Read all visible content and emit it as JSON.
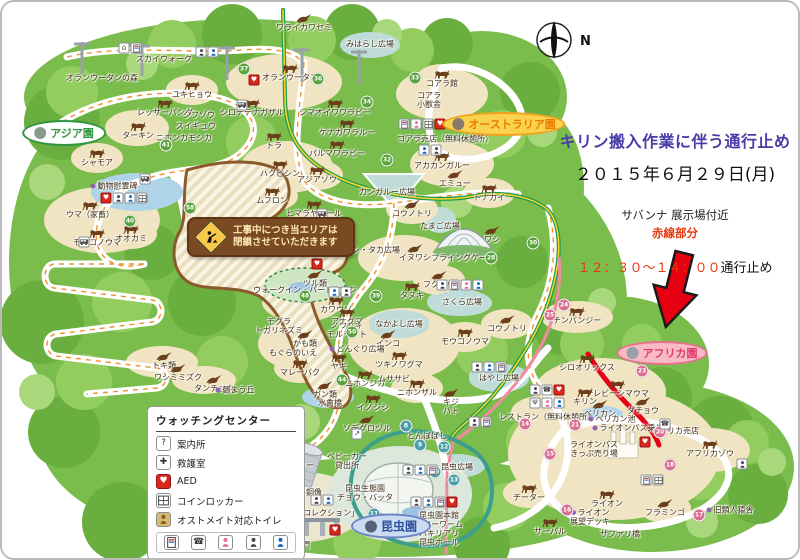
{
  "notice": {
    "title": "キリン搬入作業に伴う通行止め",
    "date": "２０１５年６月２９日(月)",
    "location_line1": "サバンナ 展示場付近",
    "location_line2": "赤線部分",
    "time": "１２：３０～１４：００",
    "time_suffix": "通行止め",
    "title_color": "#4a3ca8",
    "highlight_color": "#e8380d"
  },
  "compass": {
    "label": "N"
  },
  "construction_sign": {
    "line1": "工事中につき当エリアは",
    "line2": "閉鎖させていただきます"
  },
  "legend": {
    "title": "ウォッチングセンター",
    "items": [
      {
        "icon": "info",
        "label": "案内所"
      },
      {
        "icon": "firstaid",
        "label": "救護室"
      },
      {
        "icon": "aed",
        "label": "AED"
      },
      {
        "icon": "locker",
        "label": "コインロッカー"
      },
      {
        "icon": "ostomate",
        "label": "オストメイト対応トイレ"
      }
    ],
    "footer_icons": [
      "vending",
      "phone",
      "baby",
      "toilet",
      "wheelchair"
    ]
  },
  "areas": [
    {
      "id": "asia",
      "label": "アジア園",
      "x": 62,
      "y": 131
    },
    {
      "id": "australia",
      "label": "オーストラリア園",
      "x": 502,
      "y": 122
    },
    {
      "id": "africa",
      "label": "アフリカ園",
      "x": 660,
      "y": 351
    },
    {
      "id": "insect",
      "label": "昆虫園",
      "x": 389,
      "y": 524
    }
  ],
  "map": {
    "labels": [
      {
        "t": "ワライカワセミ",
        "x": 302,
        "y": 20,
        "k": "b",
        "np": 1
      },
      {
        "t": "みはらし広場",
        "x": 368,
        "y": 42,
        "k": "p"
      },
      {
        "t": "スカイウォーク",
        "x": 162,
        "y": 57,
        "k": "f"
      },
      {
        "t": "オランウータンの森",
        "x": 100,
        "y": 76,
        "k": "f"
      },
      {
        "t": "オランウータン",
        "x": 288,
        "y": 70,
        "k": "a"
      },
      {
        "t": "シロテテナガザル",
        "x": 250,
        "y": 105,
        "k": "a",
        "np": 1
      },
      {
        "t": "シマオイワワラビー",
        "x": 333,
        "y": 105,
        "k": "a",
        "np": 1
      },
      {
        "t": "ケナガワラルー",
        "x": 345,
        "y": 125,
        "k": "a",
        "np": 1
      },
      {
        "t": "パルマワラビー",
        "x": 335,
        "y": 146,
        "k": "a",
        "np": 1
      },
      {
        "t": "ユキヒョウ",
        "x": 190,
        "y": 87,
        "k": "a"
      },
      {
        "t": "レッサーパンダ",
        "x": 163,
        "y": 105,
        "k": "a",
        "np": 1
      },
      {
        "t": "ターキン",
        "x": 136,
        "y": 128,
        "k": "a"
      },
      {
        "t": "シフゾウ",
        "x": 197,
        "y": 113,
        "k": "t"
      },
      {
        "t": "スイギュウ",
        "x": 194,
        "y": 124,
        "k": "t"
      },
      {
        "t": "ニホンカモシカ",
        "x": 182,
        "y": 136,
        "k": "t"
      },
      {
        "t": "シャモア",
        "x": 95,
        "y": 155,
        "k": "a"
      },
      {
        "t": "トラ",
        "x": 272,
        "y": 138,
        "k": "a",
        "np": 1
      },
      {
        "t": "ハクビシン",
        "x": 278,
        "y": 166,
        "k": "a",
        "np": 1
      },
      {
        "t": "アジアゾウ",
        "x": 315,
        "y": 172,
        "k": "a"
      },
      {
        "t": "ムフロン",
        "x": 270,
        "y": 193,
        "k": "a"
      },
      {
        "t": "ヒマラヤタール",
        "x": 312,
        "y": 206,
        "k": "a",
        "np": 1
      },
      {
        "t": "ウマ（家畜）",
        "x": 88,
        "y": 207,
        "k": "a",
        "np": 1
      },
      {
        "t": "モウコノウマ",
        "x": 95,
        "y": 235,
        "k": "a"
      },
      {
        "t": "オオカミ",
        "x": 129,
        "y": 231,
        "k": "a"
      },
      {
        "t": "動物慰霊碑",
        "x": 112,
        "y": 184,
        "k": "t",
        "d": 1
      },
      {
        "t": "コアラ館",
        "x": 440,
        "y": 76,
        "k": "a"
      },
      {
        "t": "コアラ\n小獣舎",
        "x": 427,
        "y": 98,
        "k": "t"
      },
      {
        "t": "コアラ売店（無料休憩所）",
        "x": 443,
        "y": 137,
        "k": "f"
      },
      {
        "t": "アカカンガルー",
        "x": 440,
        "y": 158,
        "k": "a",
        "np": 1
      },
      {
        "t": "エミュー",
        "x": 453,
        "y": 176,
        "k": "b",
        "np": 1
      },
      {
        "t": "トナカイ",
        "x": 487,
        "y": 190,
        "k": "a"
      },
      {
        "t": "カンガルー広場",
        "x": 385,
        "y": 190,
        "k": "t"
      },
      {
        "t": "インドサイ",
        "x": 313,
        "y": 222,
        "k": "a"
      },
      {
        "t": "コウノトリ",
        "x": 410,
        "y": 206,
        "k": "b"
      },
      {
        "t": "たまご広場",
        "x": 438,
        "y": 224,
        "k": "t"
      },
      {
        "t": "ワシ",
        "x": 490,
        "y": 232,
        "k": "b",
        "np": 1
      },
      {
        "t": "フライングケージ",
        "x": 461,
        "y": 256,
        "k": "f"
      },
      {
        "t": "イヌワシ",
        "x": 413,
        "y": 250,
        "k": "b",
        "np": 1
      },
      {
        "t": "ワシ・タカ広場",
        "x": 370,
        "y": 248,
        "k": "t"
      },
      {
        "t": "フクロウ",
        "x": 437,
        "y": 277,
        "k": "b"
      },
      {
        "t": "タヌキ",
        "x": 410,
        "y": 288,
        "k": "a",
        "np": 1
      },
      {
        "t": "さくら広場",
        "x": 460,
        "y": 300,
        "k": "p"
      },
      {
        "t": "コウノトリ",
        "x": 505,
        "y": 321,
        "k": "b"
      },
      {
        "t": "なかよし広場",
        "x": 397,
        "y": 322,
        "k": "p"
      },
      {
        "t": "インコ",
        "x": 386,
        "y": 336,
        "k": "b",
        "np": 1
      },
      {
        "t": "ツキノワグマ",
        "x": 397,
        "y": 357,
        "k": "a"
      },
      {
        "t": "モウコノウマ",
        "x": 463,
        "y": 334,
        "k": "a"
      },
      {
        "t": "ニホンジカ",
        "x": 363,
        "y": 376,
        "k": "a",
        "np": 1
      },
      {
        "t": "ムササビ",
        "x": 392,
        "y": 377,
        "k": "t"
      },
      {
        "t": "ニホンザル",
        "x": 415,
        "y": 385,
        "k": "a"
      },
      {
        "t": "イノシシ",
        "x": 371,
        "y": 400,
        "k": "a",
        "np": 1
      },
      {
        "t": "キジ\nハト",
        "x": 449,
        "y": 399,
        "k": "b",
        "np": 1
      },
      {
        "t": "ソデグロヅル",
        "x": 365,
        "y": 421,
        "k": "b",
        "np": 1
      },
      {
        "t": "ノウサギ\nモルモット",
        "x": 345,
        "y": 328,
        "k": "t"
      },
      {
        "t": "どんぐり広場",
        "x": 355,
        "y": 347,
        "k": "t",
        "d": 1
      },
      {
        "t": "ヤギ",
        "x": 337,
        "y": 359,
        "k": "a",
        "np": 1
      },
      {
        "t": "ツル類",
        "x": 313,
        "y": 276,
        "k": "b"
      },
      {
        "t": "ウォークイン・バードケージ",
        "x": 303,
        "y": 288,
        "k": "f"
      },
      {
        "t": "カワウソ",
        "x": 334,
        "y": 302,
        "k": "a",
        "np": 1
      },
      {
        "t": "アナグマ",
        "x": 345,
        "y": 314,
        "k": "a",
        "np": 1
      },
      {
        "t": "モグラ\nトガリネズミ",
        "x": 277,
        "y": 324,
        "k": "t"
      },
      {
        "t": "かも類",
        "x": 303,
        "y": 336,
        "k": "b",
        "np": 1
      },
      {
        "t": "もぐらのいえ",
        "x": 291,
        "y": 351,
        "k": "t"
      },
      {
        "t": "マレーバク",
        "x": 298,
        "y": 365,
        "k": "a"
      },
      {
        "t": "ガン類",
        "x": 323,
        "y": 387,
        "k": "b",
        "np": 1
      },
      {
        "t": "水禽橋",
        "x": 328,
        "y": 401,
        "k": "f"
      },
      {
        "t": "トキ類",
        "x": 162,
        "y": 358,
        "k": "b"
      },
      {
        "t": "ワシミミズク",
        "x": 176,
        "y": 370,
        "k": "b",
        "np": 1
      },
      {
        "t": "タンチョウ",
        "x": 212,
        "y": 381,
        "k": "b",
        "np": 1
      },
      {
        "t": "鶴まう丘",
        "x": 233,
        "y": 388,
        "k": "t",
        "d": 1
      },
      {
        "t": "とんぼばし",
        "x": 425,
        "y": 434,
        "k": "f"
      },
      {
        "t": "昆虫生態園\nチョウ・バッタ",
        "x": 363,
        "y": 491,
        "k": "t"
      },
      {
        "t": "昆虫園本館\nグローワーム\nハキリアリ\n昆虫ホール",
        "x": 437,
        "y": 527,
        "k": "t"
      },
      {
        "t": "昆虫広場",
        "x": 455,
        "y": 465,
        "k": "t"
      },
      {
        "t": "ベビーカー\n貸出所",
        "x": 345,
        "y": 459,
        "k": "t"
      },
      {
        "t": "ウォッチングセンター\n動物ホール\nズーカフェ\nカンカン・ランランの銅像",
        "x": 272,
        "y": 477,
        "k": "t"
      },
      {
        "t": "ギフトショップ「コレクション」",
        "x": 297,
        "y": 511,
        "k": "f"
      },
      {
        "t": "正門",
        "x": 300,
        "y": 543,
        "k": "t"
      },
      {
        "t": "はやし広場",
        "x": 497,
        "y": 376,
        "k": "p"
      },
      {
        "t": "レストラン（無料休憩所）",
        "x": 545,
        "y": 415,
        "k": "f"
      },
      {
        "t": "チンパンジー",
        "x": 575,
        "y": 313,
        "k": "a"
      },
      {
        "t": "シロオリックス",
        "x": 585,
        "y": 360,
        "k": "a",
        "np": 1
      },
      {
        "t": "グレビーシマウマ",
        "x": 615,
        "y": 386,
        "k": "a",
        "np": 1
      },
      {
        "t": "キリン",
        "x": 583,
        "y": 394,
        "k": "a",
        "np": 1
      },
      {
        "t": "ペリカン",
        "x": 598,
        "y": 406,
        "k": "b",
        "np": 1
      },
      {
        "t": "ダチョウ",
        "x": 641,
        "y": 403,
        "k": "b",
        "np": 1
      },
      {
        "t": "ペリカン池",
        "x": 610,
        "y": 417,
        "k": "t",
        "d": 1
      },
      {
        "t": "ライオンバス乗り場",
        "x": 630,
        "y": 426,
        "k": "t",
        "d": 1
      },
      {
        "t": "アフリカ売店",
        "x": 673,
        "y": 429,
        "k": "f"
      },
      {
        "t": "ライオンバス\nきっぷ売り場",
        "x": 592,
        "y": 447,
        "k": "t"
      },
      {
        "t": "ライオン",
        "x": 605,
        "y": 496,
        "k": "a"
      },
      {
        "t": "チーター",
        "x": 527,
        "y": 490,
        "k": "a"
      },
      {
        "t": "サーバル",
        "x": 548,
        "y": 524,
        "k": "a",
        "np": 1
      },
      {
        "t": "フラミンゴ",
        "x": 663,
        "y": 505,
        "k": "b"
      },
      {
        "t": "アフリカゾウ",
        "x": 708,
        "y": 446,
        "k": "a"
      },
      {
        "t": "ライオン\n展望デッキ",
        "x": 588,
        "y": 515,
        "k": "t",
        "d": 1
      },
      {
        "t": "サファリ橋",
        "x": 618,
        "y": 532,
        "k": "f"
      },
      {
        "t": "旧類人猿舎",
        "x": 728,
        "y": 508,
        "k": "t",
        "d": 1
      }
    ],
    "route_markers": [
      {
        "n": "37",
        "x": 242,
        "y": 67,
        "c": "g"
      },
      {
        "n": "36",
        "x": 316,
        "y": 77,
        "c": "g"
      },
      {
        "n": "33",
        "x": 413,
        "y": 76,
        "c": "g"
      },
      {
        "n": "34",
        "x": 365,
        "y": 100,
        "c": "g"
      },
      {
        "n": "32",
        "x": 385,
        "y": 158,
        "c": "g"
      },
      {
        "n": "41",
        "x": 164,
        "y": 143,
        "c": "g"
      },
      {
        "n": "58",
        "x": 188,
        "y": 206,
        "c": "g"
      },
      {
        "n": "40",
        "x": 128,
        "y": 219,
        "c": "g"
      },
      {
        "n": "30",
        "x": 531,
        "y": 241,
        "c": "g"
      },
      {
        "n": "28",
        "x": 489,
        "y": 256,
        "c": "g"
      },
      {
        "n": "48",
        "x": 303,
        "y": 294,
        "c": "g"
      },
      {
        "n": "39",
        "x": 374,
        "y": 294,
        "c": "g"
      },
      {
        "n": "50",
        "x": 350,
        "y": 330,
        "c": "g"
      },
      {
        "n": "44",
        "x": 340,
        "y": 378,
        "c": "g"
      },
      {
        "n": "8",
        "x": 404,
        "y": 424,
        "c": "t"
      },
      {
        "n": "9",
        "x": 418,
        "y": 443,
        "c": "t"
      },
      {
        "n": "12",
        "x": 442,
        "y": 445,
        "c": "t"
      },
      {
        "n": "10",
        "x": 433,
        "y": 470,
        "c": "t"
      },
      {
        "n": "11",
        "x": 372,
        "y": 512,
        "c": "t"
      },
      {
        "n": "13",
        "x": 452,
        "y": 478,
        "c": "t"
      },
      {
        "n": "14",
        "x": 523,
        "y": 422,
        "c": "p"
      },
      {
        "n": "21",
        "x": 573,
        "y": 423,
        "c": "p"
      },
      {
        "n": "15",
        "x": 548,
        "y": 452,
        "c": "p"
      },
      {
        "n": "20",
        "x": 658,
        "y": 430,
        "c": "p"
      },
      {
        "n": "18",
        "x": 668,
        "y": 463,
        "c": "p"
      },
      {
        "n": "16",
        "x": 565,
        "y": 508,
        "c": "p"
      },
      {
        "n": "17",
        "x": 697,
        "y": 513,
        "c": "p"
      },
      {
        "n": "23",
        "x": 640,
        "y": 369,
        "c": "p"
      },
      {
        "n": "24",
        "x": 562,
        "y": 303,
        "c": "p"
      },
      {
        "n": "25",
        "x": 548,
        "y": 313,
        "c": "p"
      }
    ],
    "icon_clusters": [
      {
        "x": 128,
        "y": 46,
        "i": [
          "shelter",
          "vending"
        ]
      },
      {
        "x": 205,
        "y": 50,
        "i": [
          "toilet",
          "wheelchair"
        ]
      },
      {
        "x": 252,
        "y": 78,
        "i": [
          "aed"
        ]
      },
      {
        "x": 240,
        "y": 103,
        "i": [
          "bus"
        ]
      },
      {
        "x": 143,
        "y": 177,
        "i": [
          "bus"
        ]
      },
      {
        "x": 82,
        "y": 240,
        "i": [
          "bus"
        ]
      },
      {
        "x": 320,
        "y": 212,
        "i": [
          "bus"
        ]
      },
      {
        "x": 122,
        "y": 196,
        "i": [
          "aed",
          "toilet",
          "wheelchair",
          "locker"
        ]
      },
      {
        "x": 420,
        "y": 122,
        "i": [
          "vending",
          "baby",
          "locker",
          "aed"
        ]
      },
      {
        "x": 428,
        "y": 148,
        "i": [
          "wheelchair",
          "toilet"
        ]
      },
      {
        "x": 338,
        "y": 290,
        "i": [
          "wheelchair",
          "toilet"
        ]
      },
      {
        "x": 315,
        "y": 262,
        "i": [
          "aed"
        ]
      },
      {
        "x": 458,
        "y": 283,
        "i": [
          "toilet",
          "vending",
          "baby",
          "wheelchair"
        ]
      },
      {
        "x": 355,
        "y": 432,
        "i": [
          "slope"
        ]
      },
      {
        "x": 487,
        "y": 365,
        "i": [
          "toilet",
          "wheelchair",
          "vending"
        ]
      },
      {
        "x": 545,
        "y": 388,
        "i": [
          "toilet",
          "phone",
          "aed"
        ]
      },
      {
        "x": 545,
        "y": 401,
        "i": [
          "restaurant",
          "baby",
          "wheelchair"
        ]
      },
      {
        "x": 478,
        "y": 420,
        "i": [
          "toilet",
          "vending"
        ]
      },
      {
        "x": 418,
        "y": 468,
        "i": [
          "toilet",
          "wheelchair",
          "vending"
        ]
      },
      {
        "x": 432,
        "y": 500,
        "i": [
          "toilet",
          "wheelchair",
          "vending",
          "aed"
        ]
      },
      {
        "x": 663,
        "y": 422,
        "i": [
          "phone"
        ]
      },
      {
        "x": 643,
        "y": 440,
        "i": [
          "aed"
        ]
      },
      {
        "x": 740,
        "y": 462,
        "i": [
          "toilet"
        ]
      },
      {
        "x": 650,
        "y": 478,
        "i": [
          "vending",
          "locker"
        ]
      },
      {
        "x": 276,
        "y": 500,
        "i": [
          "vending",
          "locker"
        ]
      },
      {
        "x": 320,
        "y": 498,
        "i": [
          "toilet",
          "wheelchair"
        ]
      },
      {
        "x": 333,
        "y": 528,
        "i": [
          "aed"
        ]
      }
    ]
  },
  "colors": {
    "forest_green": "#7abd4d",
    "path_orange": "#ef9129",
    "route_green": "#1c9a4f",
    "route_yellow": "#f5d327",
    "route_pink": "#f08ca0",
    "route_teal": "#3d9e8c",
    "closure_red": "#e60012",
    "marker_green": "#59a33b",
    "marker_pink": "#d96f8f",
    "marker_teal": "#4a9fa8",
    "purple_dot": "#8f62b5",
    "notice_title": "#4a3ca8"
  }
}
